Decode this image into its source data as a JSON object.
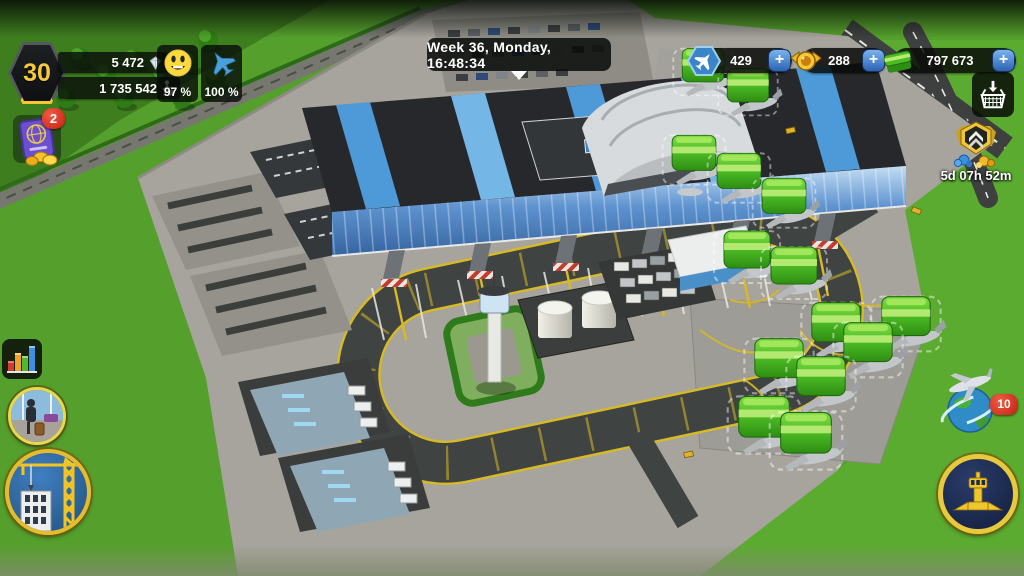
{
  "hud": {
    "level": "30",
    "gems": "5 472",
    "passengers": "1 735 542",
    "happiness": "97 %",
    "readiness": "100 %",
    "clock": "Week 36, Monday, 16:48:34",
    "planes_count": "429",
    "medals_count": "288",
    "cash_count": "797 673",
    "plus": "+",
    "passport_badge": "2",
    "event_timer": "5d 07h 52m",
    "flights_badge": "10"
  },
  "icons": {
    "level": "hexagon-level-badge",
    "gems": "gem-icon",
    "passengers": "passenger-icon",
    "happiness": "smiley-icon",
    "readiness": "plane-icon",
    "planes_resource": "plane-hex-icon",
    "medals_resource": "medal-icon",
    "cash_resource": "cash-icon",
    "add": "plus-icon",
    "shop": "basket-download-icon",
    "event": "rankup-shield-gems-icon",
    "missions": "passport-coins-icon",
    "statistics": "bar-chart-icon",
    "terminal_view": "traveler-photo-icon",
    "build": "construction-crane-icon",
    "flights_map": "plane-globe-icon",
    "harbor": "gold-tower-emblem-icon"
  },
  "colors": {
    "plus_blue": "#3e7fd0",
    "badge_red": "#d6291a",
    "gold": "#f3c52f",
    "hud_dark": "#0a0d0a",
    "grass": "#55a02c",
    "apron_grey": "#a7a49d",
    "taxiway_dark": "#3f4341",
    "taxiway_line_yellow": "#d7ba25",
    "terminal_glass_blue": "#5e93cf",
    "cash_green": "#4cbb26"
  }
}
